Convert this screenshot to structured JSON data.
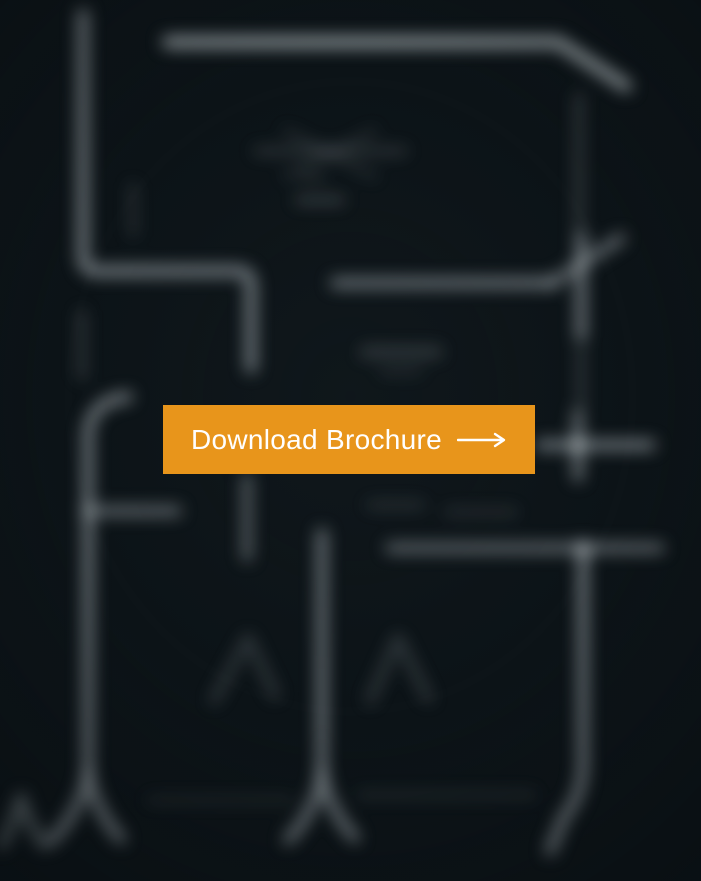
{
  "page": {
    "background_color": "#0d1418"
  },
  "background": {
    "description": "heavily blurred architectural floor plan drawing, white wall lines on dark background",
    "line_color": "#b9c2c6"
  },
  "cta": {
    "label": "Download Brochure",
    "icon": "long-right-arrow-icon",
    "background_color": "#e8951b",
    "text_color": "#ffffff"
  }
}
